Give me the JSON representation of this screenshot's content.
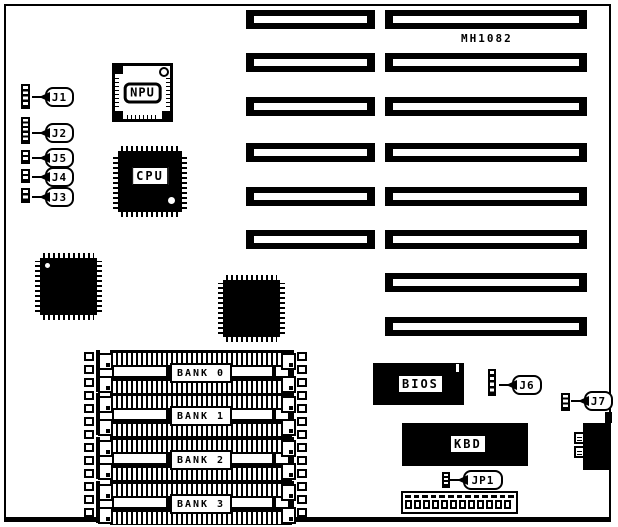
{
  "board_id_label": "MH1082",
  "chips": {
    "npu": {
      "label": "NPU"
    },
    "cpu": {
      "label": "CPU"
    },
    "bios": {
      "label": "BIOS"
    },
    "kbd": {
      "label": "KBD"
    }
  },
  "jumpers": [
    {
      "id": "j1",
      "label": "J1",
      "segs": 4,
      "hx": 21,
      "hy": 84,
      "hw": 9,
      "hh": 25,
      "bx": 45,
      "by": 87,
      "bw": 29
    },
    {
      "id": "j2",
      "label": "J2",
      "segs": 5,
      "hx": 21,
      "hy": 117,
      "hw": 9,
      "hh": 27,
      "bx": 45,
      "by": 123,
      "bw": 29
    },
    {
      "id": "j5",
      "label": "J5",
      "segs": 2,
      "hx": 21,
      "hy": 150,
      "hw": 9,
      "hh": 14,
      "bx": 45,
      "by": 148,
      "bw": 29
    },
    {
      "id": "j4",
      "label": "J4",
      "segs": 2,
      "hx": 21,
      "hy": 169,
      "hw": 9,
      "hh": 14,
      "bx": 45,
      "by": 167,
      "bw": 29
    },
    {
      "id": "j3",
      "label": "J3",
      "segs": 2,
      "hx": 21,
      "hy": 188,
      "hw": 9,
      "hh": 15,
      "bx": 45,
      "by": 187,
      "bw": 29
    },
    {
      "id": "j6",
      "label": "J6",
      "segs": 4,
      "hx": 488,
      "hy": 369,
      "hw": 8,
      "hh": 27,
      "bx": 512,
      "by": 375,
      "bw": 30
    },
    {
      "id": "j7",
      "label": "J7",
      "segs": 3,
      "hx": 561,
      "hy": 393,
      "hw": 9,
      "hh": 18,
      "bx": 584,
      "by": 391,
      "bw": 29
    },
    {
      "id": "jp1",
      "label": "JP1",
      "segs": 3,
      "hx": 442,
      "hy": 472,
      "hw": 8,
      "hh": 16,
      "bx": 463,
      "by": 470,
      "bw": 40
    }
  ],
  "memory_banks": [
    {
      "label": "BANK 0",
      "y": 350
    },
    {
      "label": "BANK 1",
      "y": 393
    },
    {
      "label": "BANK 2",
      "y": 437
    },
    {
      "label": "BANK 3",
      "y": 481
    }
  ],
  "expansion_slots": {
    "rows": [
      {
        "y": 10,
        "sixteen_bit": true
      },
      {
        "y": 53,
        "sixteen_bit": true
      },
      {
        "y": 97,
        "sixteen_bit": true
      },
      {
        "y": 143,
        "sixteen_bit": true
      },
      {
        "y": 187,
        "sixteen_bit": true
      },
      {
        "y": 230,
        "sixteen_bit": true
      },
      {
        "y": 273,
        "sixteen_bit": false
      },
      {
        "y": 317,
        "sixteen_bit": false
      }
    ],
    "left_x": 246,
    "left_w": 129,
    "right_x": 385,
    "right_w": 202,
    "h": 19
  }
}
